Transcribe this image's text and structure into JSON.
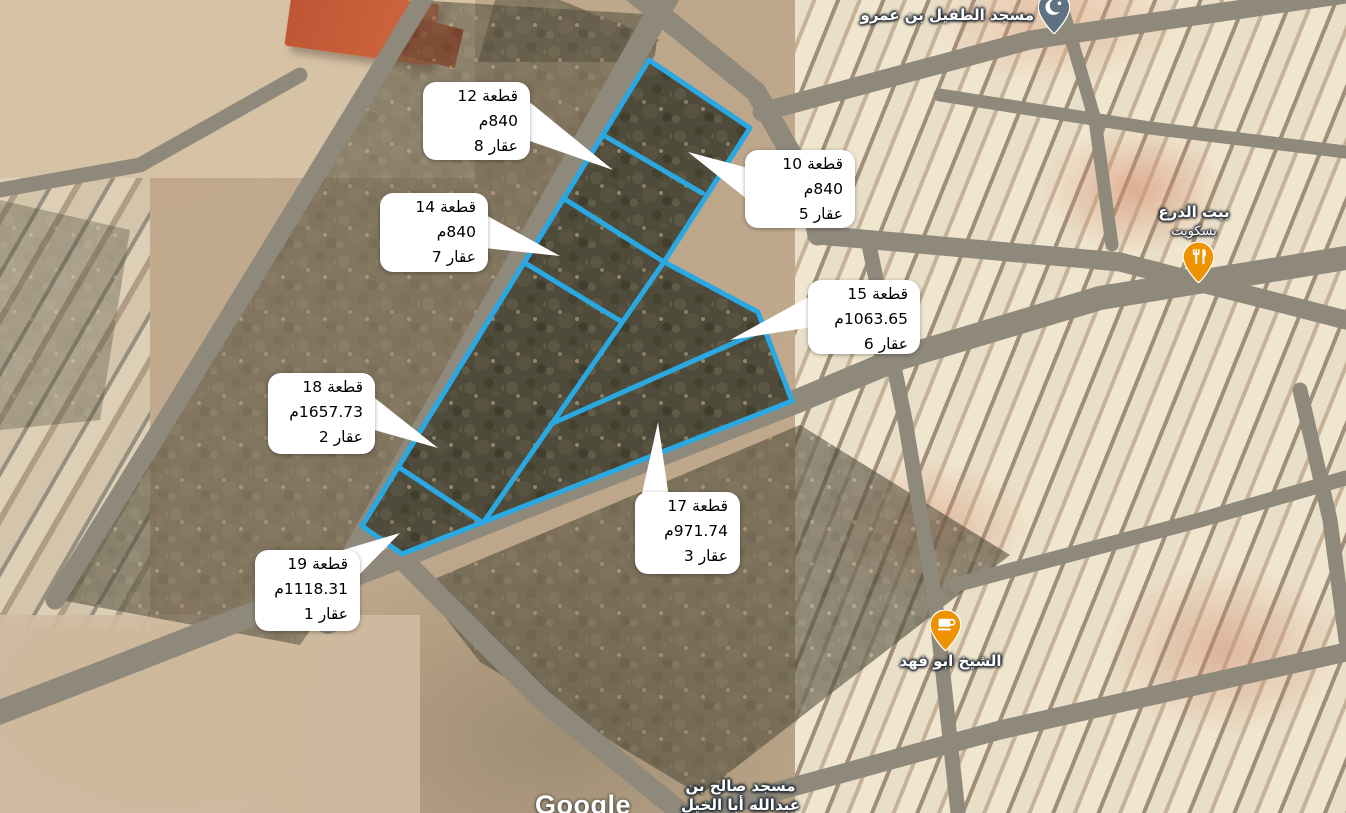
{
  "map": {
    "attribution": "Google",
    "colors": {
      "parcel_outline": "#29a8e2",
      "callout_background": "#ffffff",
      "poi_pin_orange": "#ef9200",
      "poi_pin_slate": "#5e7284"
    },
    "callouts": [
      {
        "plot": "قطعة 12",
        "area": "840م",
        "deed": "عقار 8"
      },
      {
        "plot": "قطعة 10",
        "area": "840م",
        "deed": "عقار 5"
      },
      {
        "plot": "قطعة 14",
        "area": "840م",
        "deed": "عقار 7"
      },
      {
        "plot": "قطعة 15",
        "area": "1063.65م",
        "deed": "عقار 6"
      },
      {
        "plot": "قطعة 18",
        "area": "1657.73م",
        "deed": "عقار 2"
      },
      {
        "plot": "قطعة 17",
        "area": "971.74م",
        "deed": "عقار 3"
      },
      {
        "plot": "قطعة 19",
        "area": "1118.31م",
        "deed": "عقار 1"
      }
    ],
    "pois": [
      {
        "name": "مسجد الطفيل بن عمرو",
        "type": "mosque",
        "icon": "mosque-pin-icon"
      },
      {
        "name": "بيت الدرع",
        "subtitle": "بسكويت",
        "type": "restaurant",
        "icon": "restaurant-pin-icon"
      },
      {
        "name": "الشيخ ابو فهد",
        "type": "cafe",
        "icon": "cafe-pin-icon"
      },
      {
        "name": "مسجد صالح بن",
        "name_line2": "عبدالله أبا الخيل",
        "type": "mosque-label"
      }
    ]
  }
}
